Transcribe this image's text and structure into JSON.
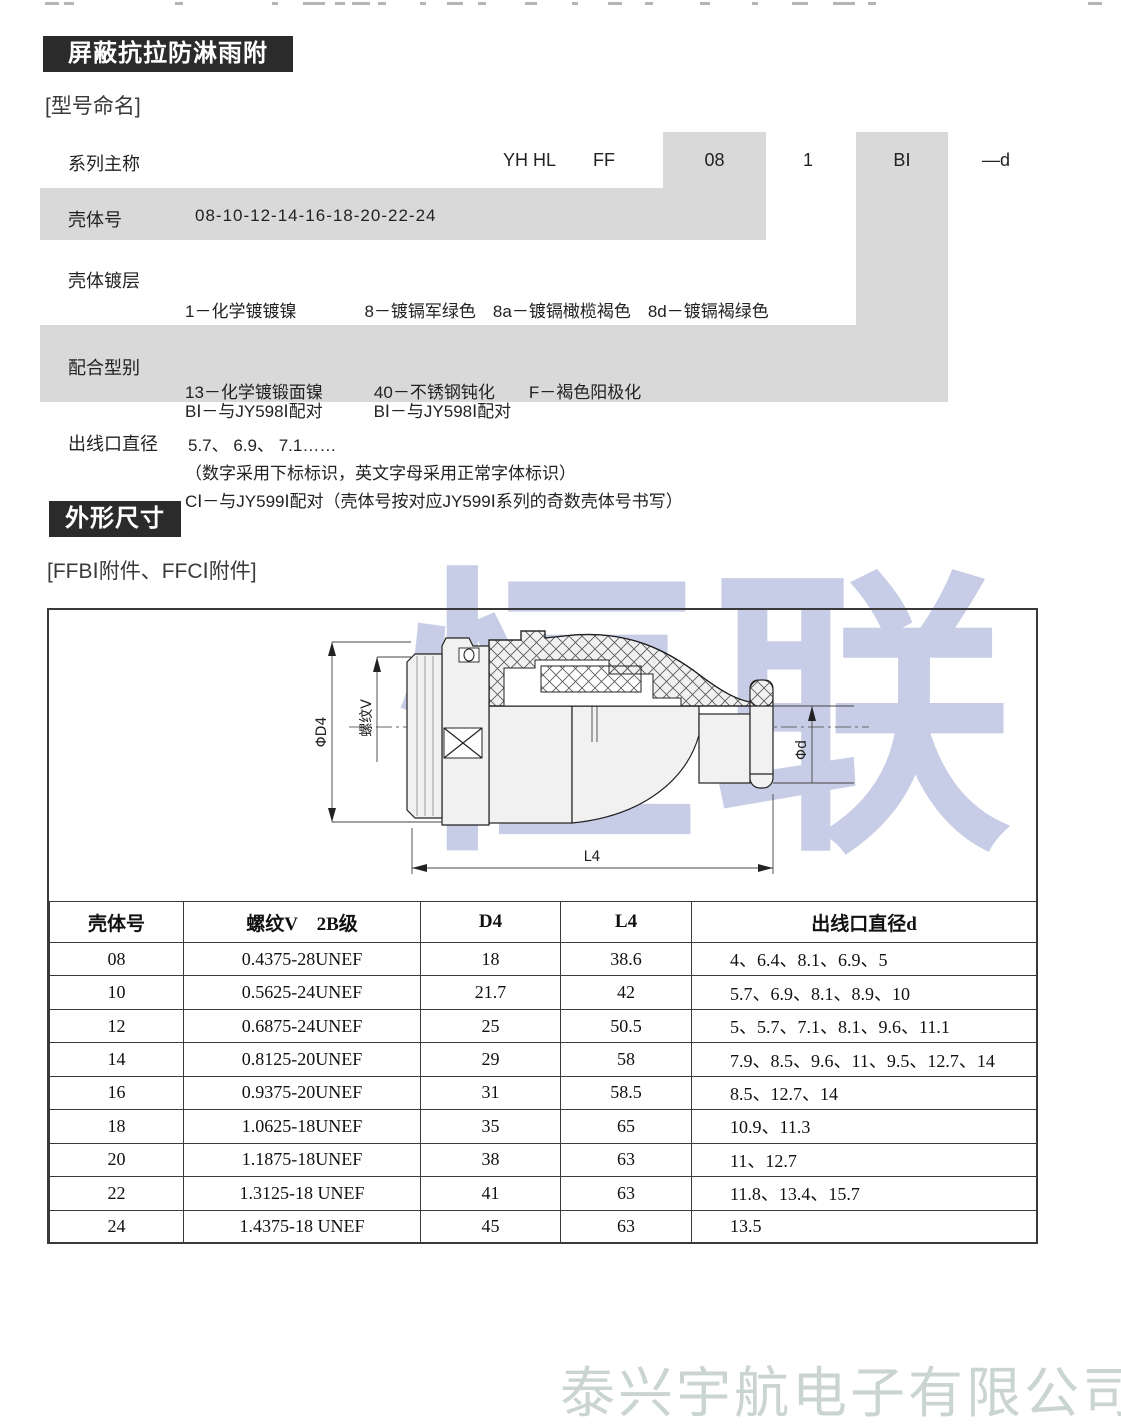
{
  "header": {
    "section1_title": "屏蔽抗拉防淋雨附件",
    "section1_tag": "[型号命名]",
    "section2_title": "外形尺寸",
    "section2_tag": "[FFBⅠ附件、FFCⅠ附件]"
  },
  "naming": {
    "series_label": "系列主称",
    "code": [
      "YH HL",
      "FF",
      "08",
      "1",
      "BⅠ",
      "—d"
    ],
    "shell_label": "壳体号",
    "shell_value": "08-10-12-14-16-18-20-22-24",
    "plating_label": "壳体镀层",
    "plating_lines": [
      "1－化学镀镀镍　　　　8－镀镉军绿色　8a－镀镉橄榄褐色　8d－镀镉褐绿色",
      "13－化学镀锻面镍　　　40－不锈钢钝化　　F－褐色阳极化",
      "（数字采用下标标识，英文字母采用正常字体标识）"
    ],
    "mating_label": "配合型别",
    "mating_lines": [
      "BⅠ－与JY598Ⅰ配对　　　BⅠ－与JY598Ⅰ配对",
      "CⅠ－与JY599Ⅰ配对（壳体号按对应JY599Ⅰ系列的奇数壳体号书写）"
    ],
    "outlet_label": "出线口直径",
    "outlet_value": "5.7、 6.9、 7.1……"
  },
  "drawing": {
    "watermark": "恒联",
    "labels": {
      "d4": "ΦD4",
      "thread": "螺纹V",
      "l4": "L4",
      "d": "Φd"
    }
  },
  "dim_table": {
    "headers": [
      "壳体号",
      "螺纹V　2B级",
      "D4",
      "L4",
      "出线口直径d"
    ],
    "rows": [
      [
        "08",
        "0.4375-28UNEF",
        "18",
        "38.6",
        "4、6.4、8.1、6.9、5"
      ],
      [
        "10",
        "0.5625-24UNEF",
        "21.7",
        "42",
        "5.7、6.9、8.1、8.9、10"
      ],
      [
        "12",
        "0.6875-24UNEF",
        "25",
        "50.5",
        "5、5.7、7.1、8.1、9.6、11.1"
      ],
      [
        "14",
        "0.8125-20UNEF",
        "29",
        "58",
        "7.9、8.5、9.6、11、9.5、12.7、14"
      ],
      [
        "16",
        "0.9375-20UNEF",
        "31",
        "58.5",
        "8.5、12.7、14"
      ],
      [
        "18",
        "1.0625-18UNEF",
        "35",
        "65",
        "10.9、11.3"
      ],
      [
        "20",
        "1.1875-18UNEF",
        "38",
        "63",
        "11、12.7"
      ],
      [
        "22",
        "1.3125-18 UNEF",
        "41",
        "63",
        "11.8、13.4、15.7"
      ],
      [
        "24",
        "1.4375-18 UNEF",
        "45",
        "63",
        "13.5"
      ]
    ]
  },
  "footer": {
    "company_watermark": "泰兴宇航电子有限公司"
  },
  "colors": {
    "header_bar": "#2b2b2b",
    "shade_gray": "#d9d9d9",
    "watermark_blue": "rgba(122,136,196,0.42)",
    "watermark_footer": "#cbd5d0"
  },
  "scan_artifacts": {
    "top_marks": [
      [
        45,
        14
      ],
      [
        64,
        10
      ],
      [
        175,
        8
      ],
      [
        272,
        6
      ],
      [
        303,
        22
      ],
      [
        335,
        10
      ],
      [
        352,
        18
      ],
      [
        378,
        8
      ],
      [
        420,
        6
      ],
      [
        447,
        16
      ],
      [
        478,
        8
      ],
      [
        525,
        12
      ],
      [
        572,
        6
      ],
      [
        608,
        14
      ],
      [
        645,
        8
      ],
      [
        700,
        10
      ],
      [
        752,
        6
      ],
      [
        792,
        16
      ],
      [
        833,
        22
      ],
      [
        868,
        8
      ],
      [
        1088,
        14
      ]
    ]
  }
}
